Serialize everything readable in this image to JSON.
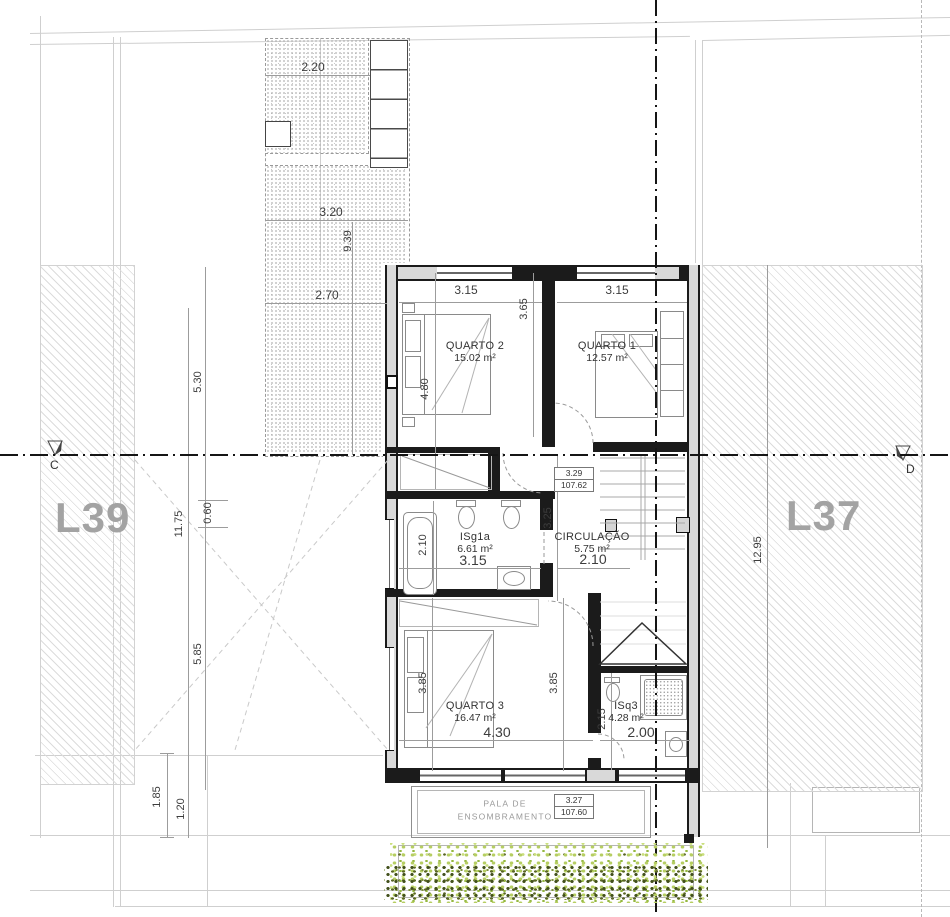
{
  "site": {
    "lot_left_label": "L39",
    "lot_right_label": "L37",
    "section_left": "C",
    "section_right": "D"
  },
  "rooms": [
    {
      "id": "quarto-2",
      "name": "QUARTO 2",
      "area": "15.02 m²",
      "x": 475,
      "y": 352
    },
    {
      "id": "quarto-1",
      "name": "QUARTO 1",
      "area": "12.57 m²",
      "x": 607,
      "y": 352
    },
    {
      "id": "isg1a",
      "name": "ISg1a",
      "area": "6.61 m²",
      "x": 475,
      "y": 543
    },
    {
      "id": "circulacao",
      "name": "CIRCULAÇÃO",
      "area": "5.75 m²",
      "x": 592,
      "y": 543
    },
    {
      "id": "quarto-3",
      "name": "QUARTO 3",
      "area": "16.47 m²",
      "x": 475,
      "y": 712
    },
    {
      "id": "isq3",
      "name": "ISq3",
      "area": "4.28 m²",
      "x": 626,
      "y": 712
    }
  ],
  "dimensions": [
    {
      "t": "2.20",
      "x": 313,
      "y": 67,
      "rot": 0,
      "s": "md"
    },
    {
      "t": "3.20",
      "x": 331,
      "y": 212,
      "rot": 0,
      "s": "md"
    },
    {
      "t": "9.39",
      "x": 348,
      "y": 241,
      "rot": 1
    },
    {
      "t": "2.70",
      "x": 327,
      "y": 295,
      "rot": 0,
      "s": "md"
    },
    {
      "t": "5.30",
      "x": 198,
      "y": 382,
      "rot": 1
    },
    {
      "t": "11.75",
      "x": 179,
      "y": 524,
      "rot": 1
    },
    {
      "t": "0.60",
      "x": 208,
      "y": 513,
      "rot": 1
    },
    {
      "t": "5.85",
      "x": 198,
      "y": 654,
      "rot": 1
    },
    {
      "t": "1.85",
      "x": 157,
      "y": 797,
      "rot": 1
    },
    {
      "t": "1.20",
      "x": 181,
      "y": 809,
      "rot": 1
    },
    {
      "t": "12.95",
      "x": 758,
      "y": 550,
      "rot": 1
    },
    {
      "t": "3.15",
      "x": 466,
      "y": 290,
      "rot": 0,
      "s": "md"
    },
    {
      "t": "3.15",
      "x": 617,
      "y": 290,
      "rot": 0,
      "s": "md"
    },
    {
      "t": "4.80",
      "x": 425,
      "y": 389,
      "rot": 1
    },
    {
      "t": "3.65",
      "x": 524,
      "y": 309,
      "rot": 1
    },
    {
      "t": "3.25",
      "x": 548,
      "y": 518,
      "rot": 1
    },
    {
      "t": "2.10",
      "x": 423,
      "y": 545,
      "rot": 1
    },
    {
      "t": "3.15",
      "x": 473,
      "y": 560,
      "rot": 0,
      "s": "lg"
    },
    {
      "t": "2.10",
      "x": 593,
      "y": 559,
      "rot": 0,
      "s": "lg"
    },
    {
      "t": "3.85",
      "x": 423,
      "y": 683,
      "rot": 1
    },
    {
      "t": "3.85",
      "x": 554,
      "y": 683,
      "rot": 1
    },
    {
      "t": "4.30",
      "x": 497,
      "y": 732,
      "rot": 0,
      "s": "lg"
    },
    {
      "t": "2.15",
      "x": 602,
      "y": 719,
      "rot": 1
    },
    {
      "t": "2.00",
      "x": 641,
      "y": 732,
      "rot": 0,
      "s": "lg"
    }
  ],
  "levels": [
    {
      "rel": "3.29",
      "abs": "107.62"
    },
    {
      "rel": "3.27",
      "abs": "107.60"
    }
  ],
  "pala": {
    "line1": "PALA DE",
    "line2": "ENSOMBRAMENTO"
  },
  "colors": {
    "wall": "#1b1b1b",
    "wall_fill": "#d9d9d9",
    "hatch": "#dcdcdc",
    "veg_light": "#b6ce62",
    "veg_dark": "#42501c"
  }
}
